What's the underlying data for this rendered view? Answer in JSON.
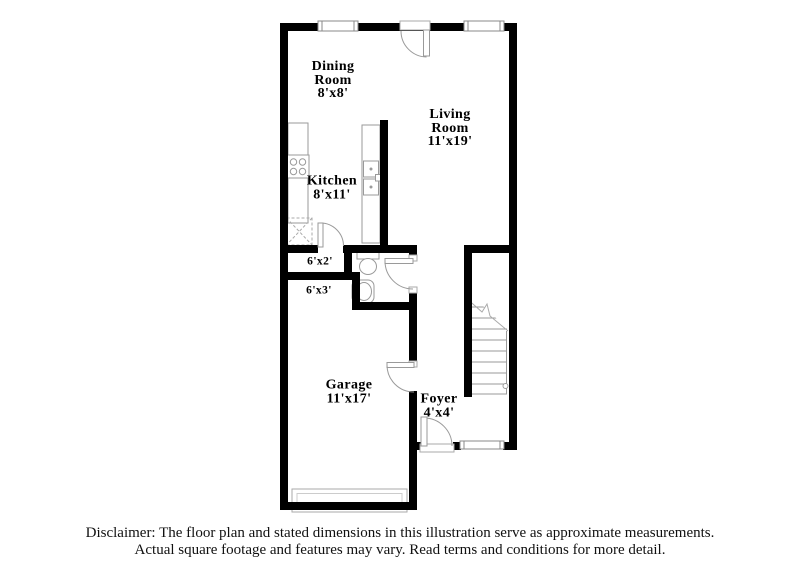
{
  "title": "Floor plan illustration",
  "rooms": {
    "dining": {
      "lines": [
        "Dining",
        "Room",
        "8'x8'"
      ]
    },
    "living": {
      "lines": [
        "Living",
        "Room",
        "11'x19'"
      ]
    },
    "kitchen": {
      "lines": [
        "Kitchen",
        "8'x11'"
      ]
    },
    "closet": {
      "lines": [
        "6'x2'"
      ]
    },
    "hall": {
      "lines": [
        "6'x3'"
      ]
    },
    "garage": {
      "lines": [
        "Garage",
        "11'x17'"
      ]
    },
    "foyer": {
      "lines": [
        "Foyer",
        "4'x4'"
      ]
    }
  },
  "fixtures": [
    "stove",
    "kitchen-counter",
    "kitchen-sink",
    "pantry-box",
    "toilet",
    "bathroom-sink",
    "stairs",
    "garage-door",
    "windows",
    "doors"
  ],
  "colors": {
    "wall": "#000000",
    "fixture_outline": "#9a9a9a",
    "window_outline": "#888888",
    "text": "#000000",
    "background": "#ffffff"
  },
  "disclaimer": {
    "line1": "Disclaimer: The floor plan and stated dimensions in this illustration serve as approximate measurements.",
    "line2": "Actual square footage and features may vary. Read terms and conditions for more detail."
  }
}
